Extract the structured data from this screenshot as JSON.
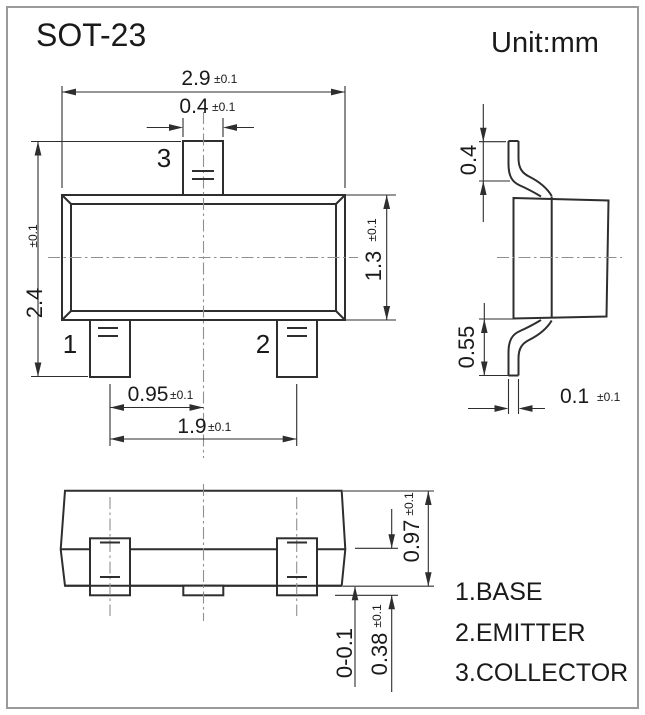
{
  "title": "SOT-23",
  "unit": "Unit:mm",
  "top_view": {
    "dim_body_width": {
      "v": "2.9",
      "t": "±0.1"
    },
    "dim_tab_width": {
      "v": "0.4",
      "t": "±0.1"
    },
    "dim_overall": {
      "v": "2.4",
      "t": "±0.1"
    },
    "dim_body_height": {
      "v": "1.3",
      "t": "±0.1"
    },
    "dim_pin_offset": {
      "v": "0.95",
      "t": "±0.1"
    },
    "dim_pin_pitch": {
      "v": "1.9",
      "t": "±0.1"
    },
    "pin1": "1",
    "pin2": "2",
    "pin3": "3"
  },
  "side_view": {
    "dim_lead_top": "0.4",
    "dim_lead_bottom": "0.55",
    "dim_lead_thickness": {
      "v": "0.1",
      "t": "±0.1"
    }
  },
  "front_view": {
    "dim_height": {
      "v": "0.97",
      "t": "±0.1"
    },
    "dim_lead": {
      "v": "0.38",
      "t": "±0.1"
    },
    "dim_standoff": "0-0.1"
  },
  "legend": [
    {
      "label": "1.BASE"
    },
    {
      "label": "2.EMITTER"
    },
    {
      "label": "3.COLLECTOR"
    }
  ],
  "colors": {
    "line": "#2e2e2e",
    "text": "#1a1a1a",
    "centerline": "#8f8f8f",
    "border": "#9a9a9a",
    "background": "#ffffff"
  }
}
